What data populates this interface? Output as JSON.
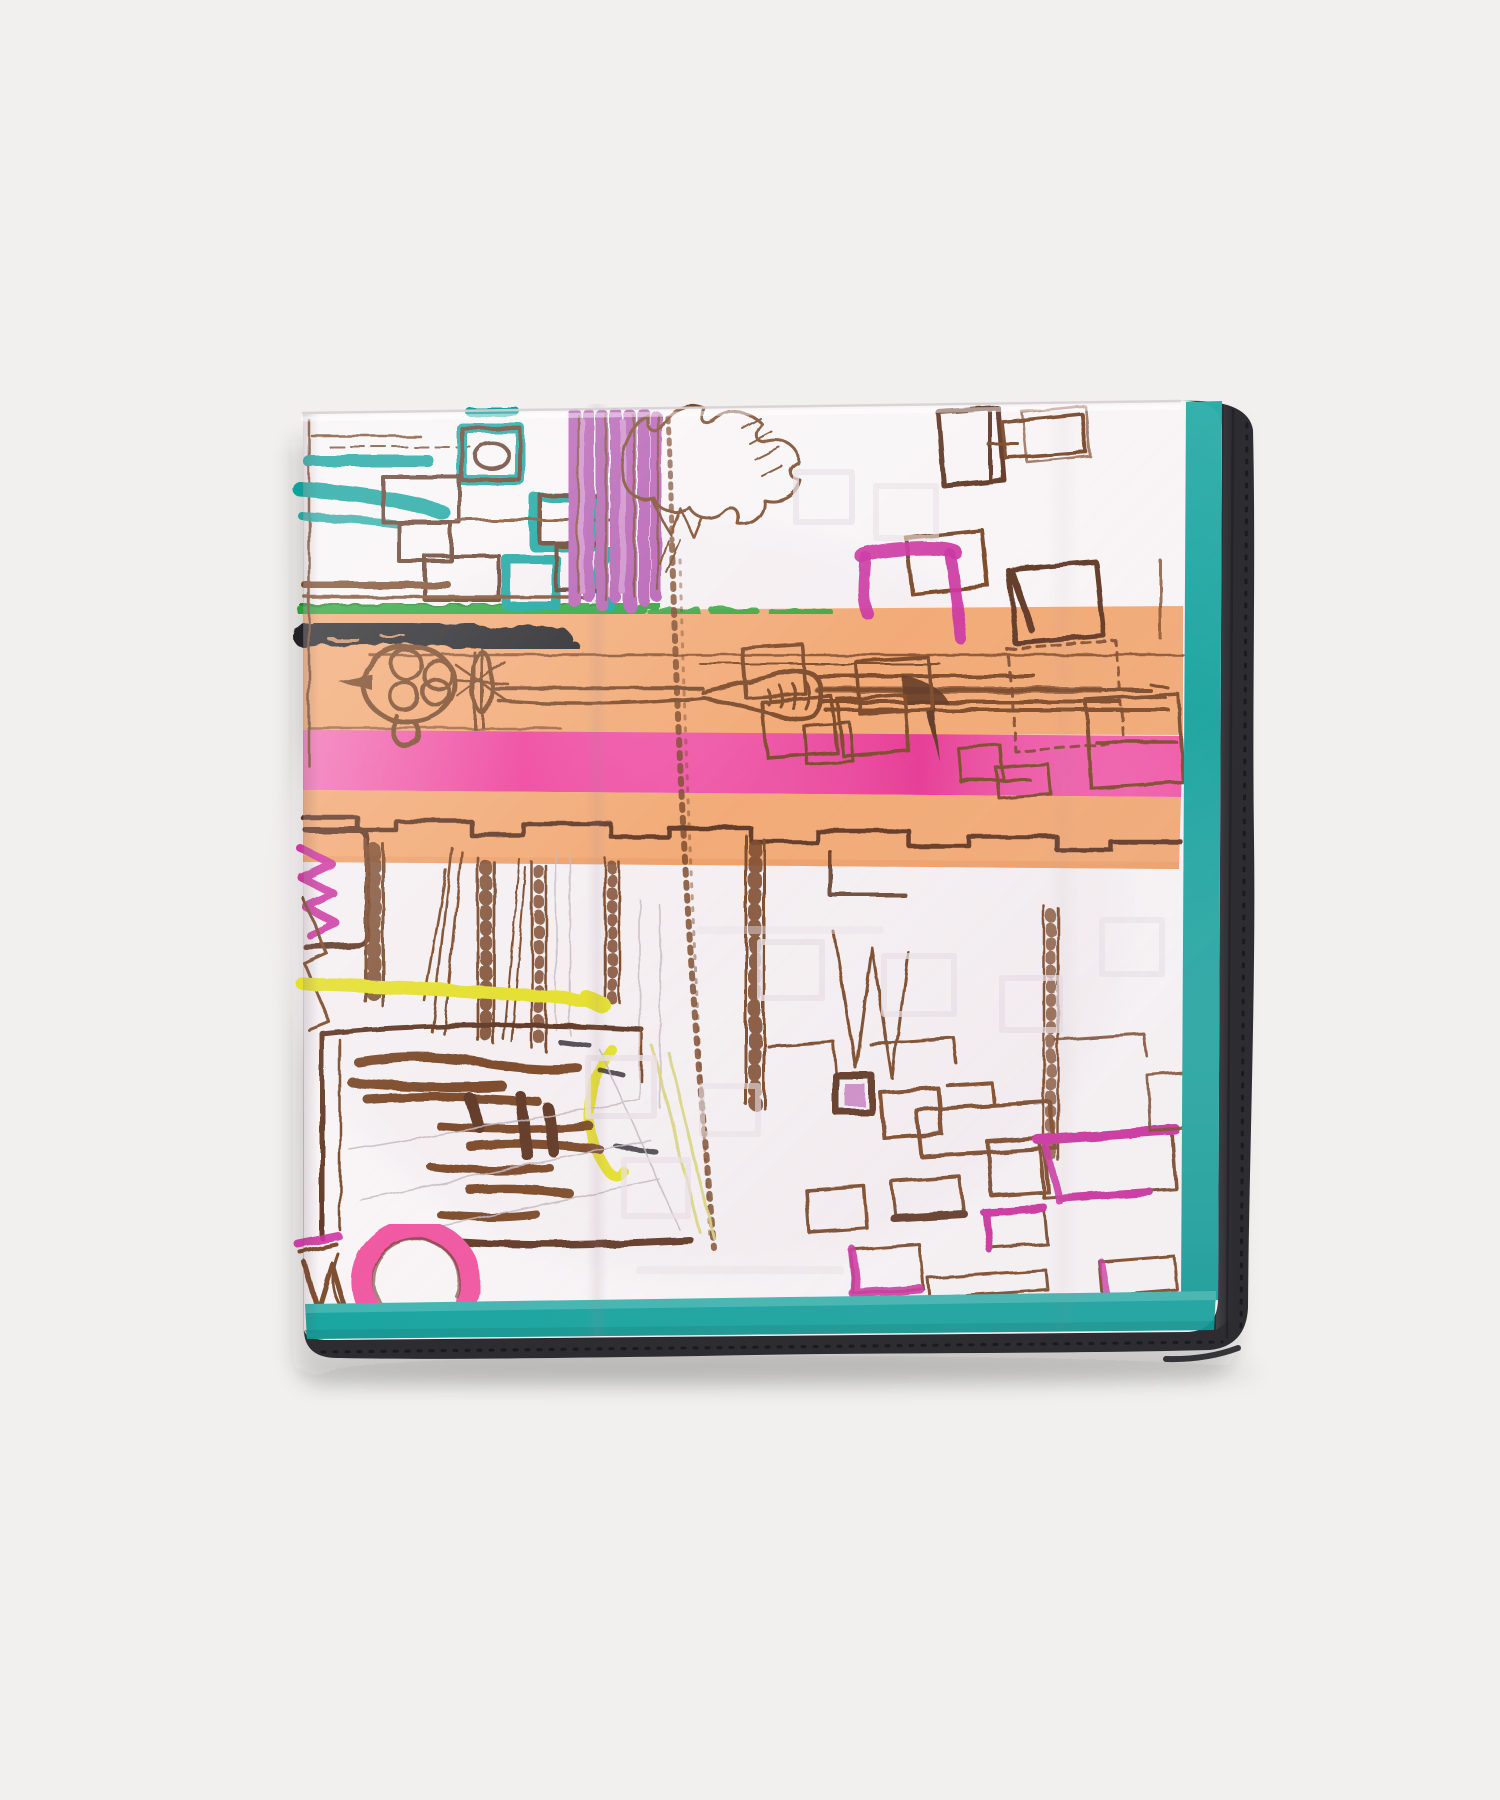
{
  "photo": {
    "subject": "folded-silk-pocket-square",
    "print_style": "hand-sketched-cityscape",
    "background": "studio-white"
  },
  "scarf": {
    "borders": [
      "teal-inner-border",
      "black-rolled-hem"
    ],
    "motifs": [
      "window-facade-with-teal-accents",
      "purple-curtain-strokes",
      "tree-scribble",
      "street-lamp-sketch",
      "grass-stroke",
      "charcoal-stroke",
      "orange-road-band",
      "pink-road-band",
      "stepped-skyline-line",
      "ladder-facade-strips",
      "magenta-monogram-scribble",
      "scribble-building-block",
      "yellow-underline",
      "yellow-hook",
      "pink-ring",
      "scattered-window-squares",
      "magenta-accent-squares"
    ]
  },
  "colors": {
    "background": "#f1f0ee",
    "fabric_white": "#f9f5f7",
    "fabric_tint": "#f2ebef",
    "border_teal": "#0fa19c",
    "border_teal_deep": "#0c8d89",
    "hem_black": "#2d2c31",
    "hem_black_light": "#47464c",
    "band_orange": "#f2a873",
    "band_orange_deep": "#eb9a60",
    "band_pink": "#ee3e9a",
    "band_pink_deep": "#dd2b8a",
    "ring_pink": "#f0529f",
    "curtain_purple": "#b55cb2",
    "curtain_purple_light": "#cd8cc9",
    "accent_magenta": "#cb2f9f",
    "sketch_brown": "#7a4728",
    "sketch_dark_brown": "#5e3520",
    "stroke_black": "#242127",
    "grass_green": "#2ca238",
    "grass_green_dark": "#1f8a2c",
    "accent_yellow": "#e4df2b",
    "accent_yellow_pale": "#d8d37c",
    "ghost_gray": "#e8e0e5",
    "pencil_gray": "#c3b6bd",
    "shadow": "rgba(31,28,30,0.16)"
  }
}
